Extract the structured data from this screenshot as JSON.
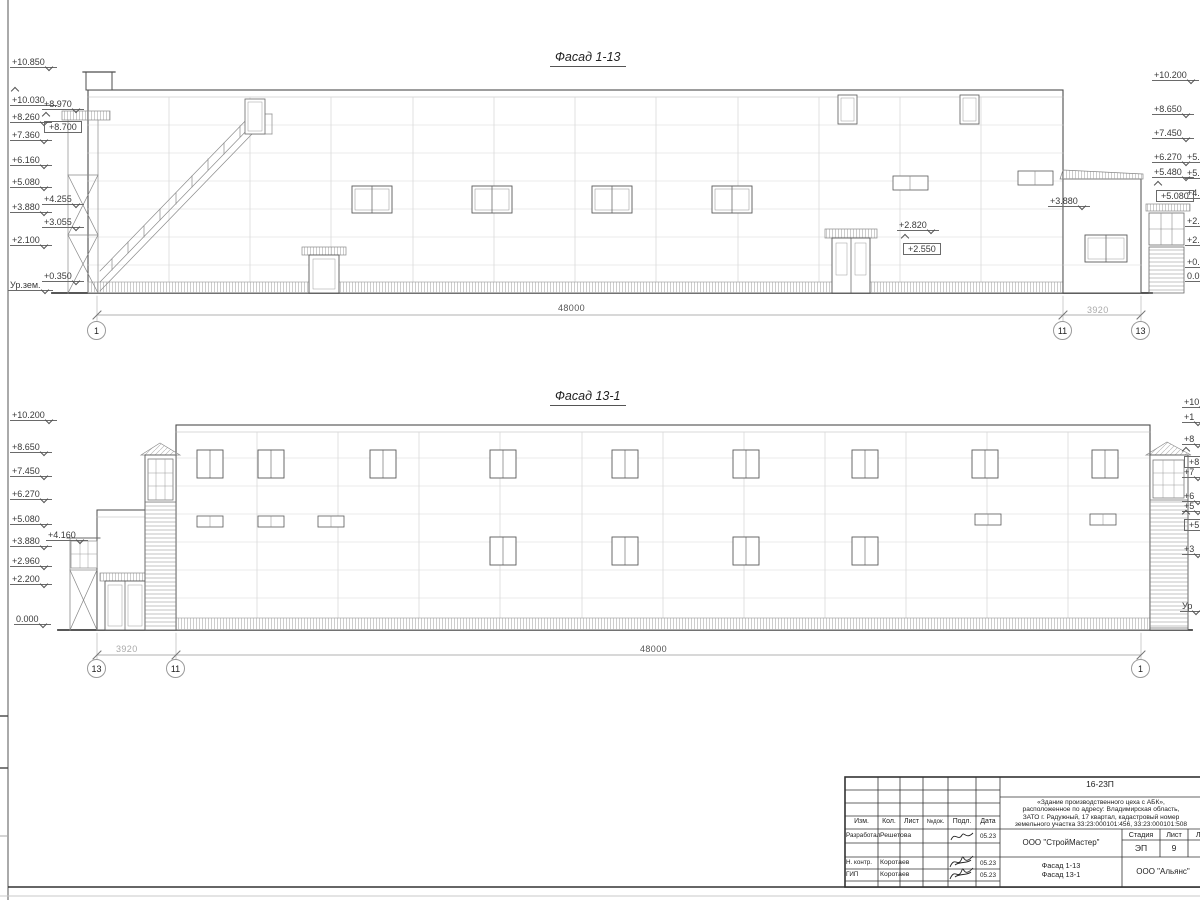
{
  "facade1": {
    "title": "Фасад 1-13",
    "left": [
      "+10.850",
      "+10.030",
      "+8.970",
      "+8.260",
      "+8.700",
      "+7.360",
      "+6.160",
      "+5.080",
      "+4.255",
      "+3.880",
      "+3.055",
      "+2.100",
      "+0.350",
      "Ур.зем."
    ],
    "right": [
      "+10.200",
      "+8.650",
      "+7.450",
      "+6.270",
      "+5.480",
      "+5.080"
    ],
    "right_cut": [
      "+5.",
      "+5.",
      "+4.",
      "+2.",
      "+2.",
      "+0.",
      "0.0"
    ],
    "mid": [
      "+2.820",
      "+2.550",
      "+3.880"
    ],
    "dim_main": "48000",
    "dim_side": "3920",
    "axis": [
      "1",
      "11",
      "13"
    ]
  },
  "facade2": {
    "title": "Фасад 13-1",
    "left": [
      "+10.200",
      "+8.650",
      "+7.450",
      "+6.270",
      "+5.080",
      "+3.880",
      "+4.160",
      "+2.960",
      "+2.200",
      "0.000"
    ],
    "right_cut": [
      "+10",
      "+1",
      "+8",
      "+8",
      "+7",
      "+6",
      "+5",
      "+5",
      "+3",
      "Ур"
    ],
    "dim_main": "48000",
    "dim_side": "3920",
    "axis": [
      "13",
      "11",
      "1"
    ]
  },
  "titleblock": {
    "doc_number": "16-23П",
    "object_lines": [
      "«Здание производственного цеха с АБК»,",
      "расположенное по адресу: Владимирская область,",
      "ЗАТО г. Радужный, 17 квартал, кадастровый номер",
      "земельного участка 33:23:000101:456, 33:23:000101:508"
    ],
    "columns": [
      "Изм.",
      "Кол.",
      "Лист",
      "№док.",
      "Подл.",
      "Дата"
    ],
    "rows": [
      {
        "role": "Разработал",
        "name": "Решетова",
        "date": "05.23"
      },
      {
        "role": "Н. контр.",
        "name": "Коротаев",
        "date": "05.23"
      },
      {
        "role": "ГИП",
        "name": "Коротаев",
        "date": "05.23"
      }
    ],
    "designer_org": "ООО \"СтройМастер\"",
    "stage_label": "Стадия",
    "sheet_label": "Лист",
    "sheets_label": "Лис",
    "stage": "ЭП",
    "sheet_no": "9",
    "sheets_total": "1",
    "drawing_titles": [
      "Фасад 1-13",
      "Фасад 13-1"
    ],
    "client_org": "ООО \"Альянс\""
  }
}
